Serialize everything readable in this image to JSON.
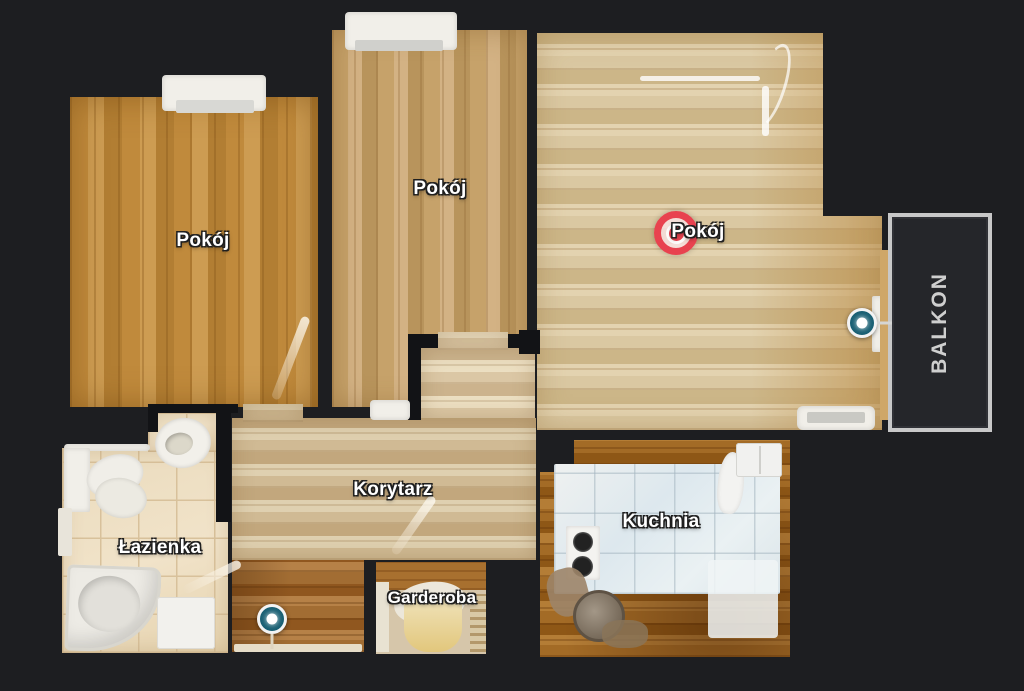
{
  "app": {
    "view": "floor-plan",
    "background_color": "#1d1e21"
  },
  "rooms": {
    "room_top_left": {
      "label": "Pokój"
    },
    "room_top_middle": {
      "label": "Pokój"
    },
    "room_right": {
      "label": "Pokój"
    },
    "corridor": {
      "label": "Korytarz"
    },
    "bathroom": {
      "label": "Łazienka"
    },
    "wardrobe": {
      "label": "Garderoba"
    },
    "kitchen": {
      "label": "Kuchnia"
    },
    "balcony": {
      "label": "BALKON"
    }
  },
  "markers": {
    "current_position": {
      "located_in": "Pokój",
      "color": "#e8424f"
    },
    "waypoints": [
      {
        "id": "waypoint-balcony-door",
        "located_in": "Pokój",
        "color": "#175e72"
      },
      {
        "id": "waypoint-corridor",
        "located_in": "Korytarz",
        "color": "#175e72"
      }
    ]
  },
  "colors": {
    "balcony_border": "#c8c8c8",
    "balcony_label_text": "#cfcfcf",
    "room_label_text": "#ffffff"
  }
}
